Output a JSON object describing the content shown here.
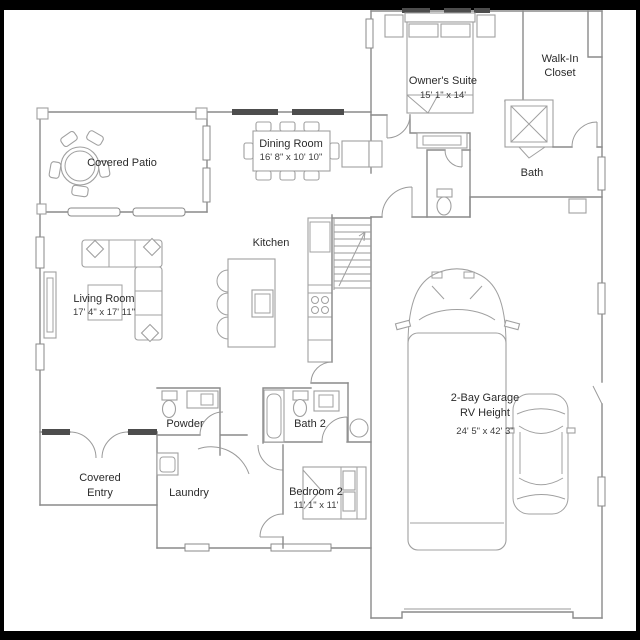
{
  "plan": {
    "title": "Floor plan",
    "colors": {
      "background": "#ffffff",
      "frame": "#000000",
      "wall": "#8a8a8a",
      "window_dark": "#4d4d4d",
      "text": "#2b2b2b"
    },
    "rooms": {
      "owners_suite": {
        "name": "Owner's Suite",
        "dims": "15' 1\" x 14'"
      },
      "walk_in_closet": {
        "line1": "Walk-In",
        "line2": "Closet"
      },
      "bath": {
        "name": "Bath"
      },
      "covered_patio": {
        "name": "Covered Patio"
      },
      "dining_room": {
        "name": "Dining Room",
        "dims": "16' 8\" x 10' 10\""
      },
      "kitchen": {
        "name": "Kitchen"
      },
      "living_room": {
        "name": "Living Room",
        "dims": "17' 4\" x 17' 11\""
      },
      "powder": {
        "name": "Powder"
      },
      "bath2": {
        "name": "Bath 2"
      },
      "covered_entry": {
        "line1": "Covered",
        "line2": "Entry"
      },
      "laundry": {
        "name": "Laundry"
      },
      "bedroom2": {
        "name": "Bedroom 2",
        "dims": "11' 1\" x 11'"
      },
      "garage": {
        "line1": "2-Bay Garage",
        "line2": "RV Height",
        "dims": "24' 5\" x 42' 3\""
      }
    }
  }
}
